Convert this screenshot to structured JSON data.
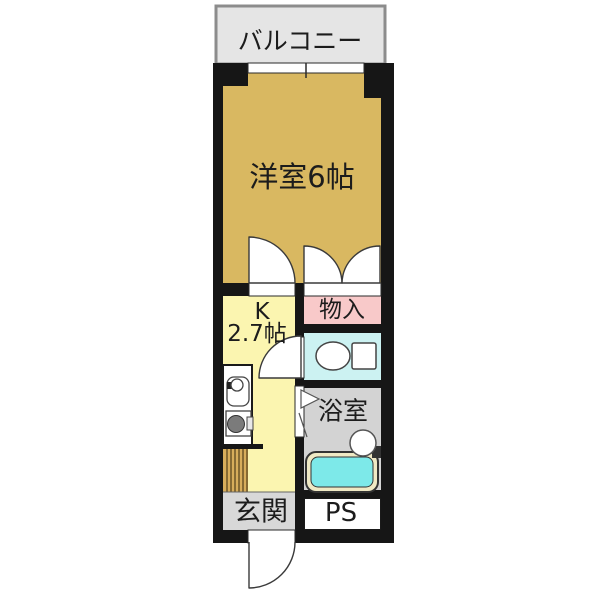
{
  "plan": {
    "balcony": {
      "label": "バルコニー"
    },
    "rooms": {
      "western_room": {
        "label": "洋室6帖"
      },
      "kitchen": {
        "label_line1": "K",
        "label_line2": "2.7帖"
      },
      "closet": {
        "label": "物入"
      },
      "bath": {
        "label": "浴室"
      },
      "entrance": {
        "label": "玄関"
      },
      "pipe_space": {
        "label": "PS"
      }
    },
    "icons": [
      "toilet-icon",
      "bathtub-icon",
      "washbasin-icon",
      "kitchen-sink-icon",
      "stove-burner-icon",
      "entrance-step-icon",
      "door-swing-arc",
      "double-door-swing-arc",
      "folding-door-icon",
      "window-symbol"
    ],
    "colors": {
      "wall": "#161616",
      "western_room": "#D9B861",
      "kitchen": "#FBF5B0",
      "closet": "#F8C9C9",
      "toilet": "#CCF2F2",
      "bath": "#D3D3D3",
      "entrance": "#D8D8D8",
      "balcony": "#E5E5E5",
      "tub_rim": "#EFE9C4",
      "tub_water": "#7DE9E9",
      "step": "#D7AD5B",
      "outline": "#333333"
    }
  }
}
